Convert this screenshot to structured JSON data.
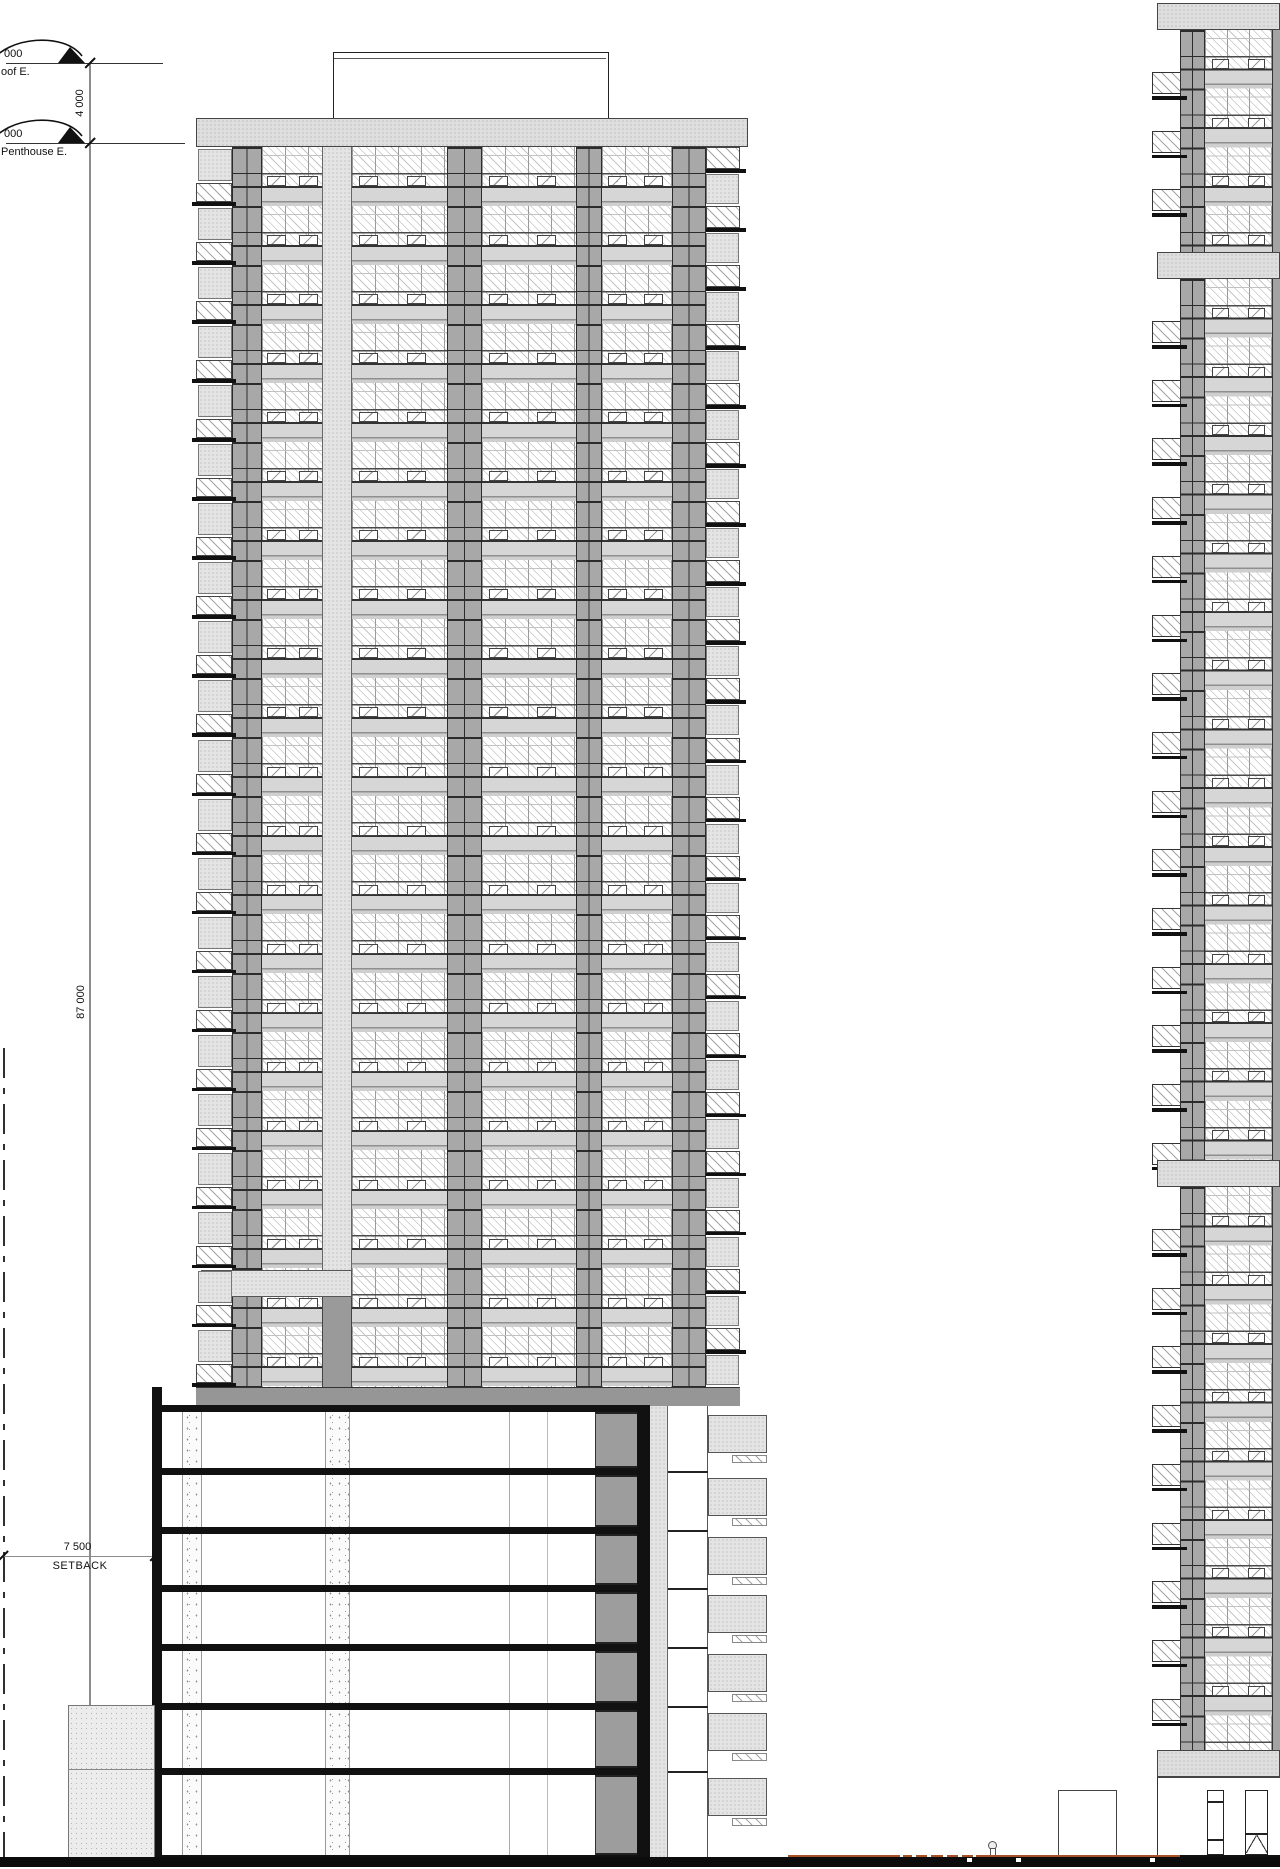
{
  "drawing": {
    "title": "building-section-elevation",
    "levels": [
      {
        "value": "000",
        "label": "oof E."
      },
      {
        "value": "000",
        "label": "Penthouse E."
      }
    ],
    "dimensions": {
      "roof_to_penthouse": "4 000",
      "penthouse_to_ground": "87 000",
      "setback_value": "7 500",
      "setback_label": "SETBACK"
    },
    "structure": {
      "tower_floors": 21,
      "podium_floors": 7,
      "neighbor_building_visible": true
    },
    "colors": {
      "ink": "#1a1a1a",
      "section_black": "#111111",
      "pier_gray": "#a8a8a8",
      "spandrel_gray": "#d5d5d5",
      "stipple_gray": "#e4e4e4",
      "dark_panel": "#9d9d9d",
      "base_band": "#969696",
      "dim_line": "#8c8c8c",
      "ground_red": "#a8502c"
    }
  }
}
